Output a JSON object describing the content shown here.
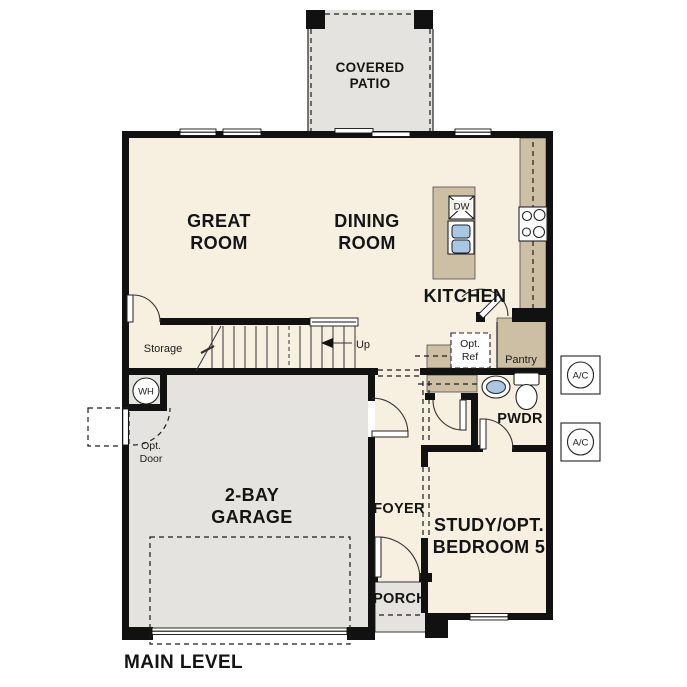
{
  "plan": {
    "title": "MAIN LEVEL",
    "rooms": {
      "covered_patio": [
        "COVERED",
        "PATIO"
      ],
      "great_room": [
        "GREAT",
        "ROOM"
      ],
      "dining_room": [
        "DINING",
        "ROOM"
      ],
      "kitchen": "KITCHEN",
      "storage": "Storage",
      "pantry": "Pantry",
      "powder": "PWDR",
      "foyer": "FOYER",
      "porch": "PORCH",
      "garage": [
        "2-BAY",
        "GARAGE"
      ],
      "study": [
        "STUDY/OPT.",
        "BEDROOM 5"
      ]
    },
    "annotations": {
      "up": "Up",
      "opt_ref": [
        "Opt.",
        "Ref"
      ],
      "opt_door": [
        "Opt.",
        "Door"
      ],
      "wh": "WH",
      "dw": "DW",
      "ac_top": "A/C",
      "ac_bottom": "A/C"
    },
    "colors": {
      "wall": "#111111",
      "floor": "#f7efe0",
      "concrete": "#e4e3df",
      "counter": "#cdbfa4",
      "sink_blue": "#a9c7e2",
      "fixture": "#ededeb"
    }
  }
}
